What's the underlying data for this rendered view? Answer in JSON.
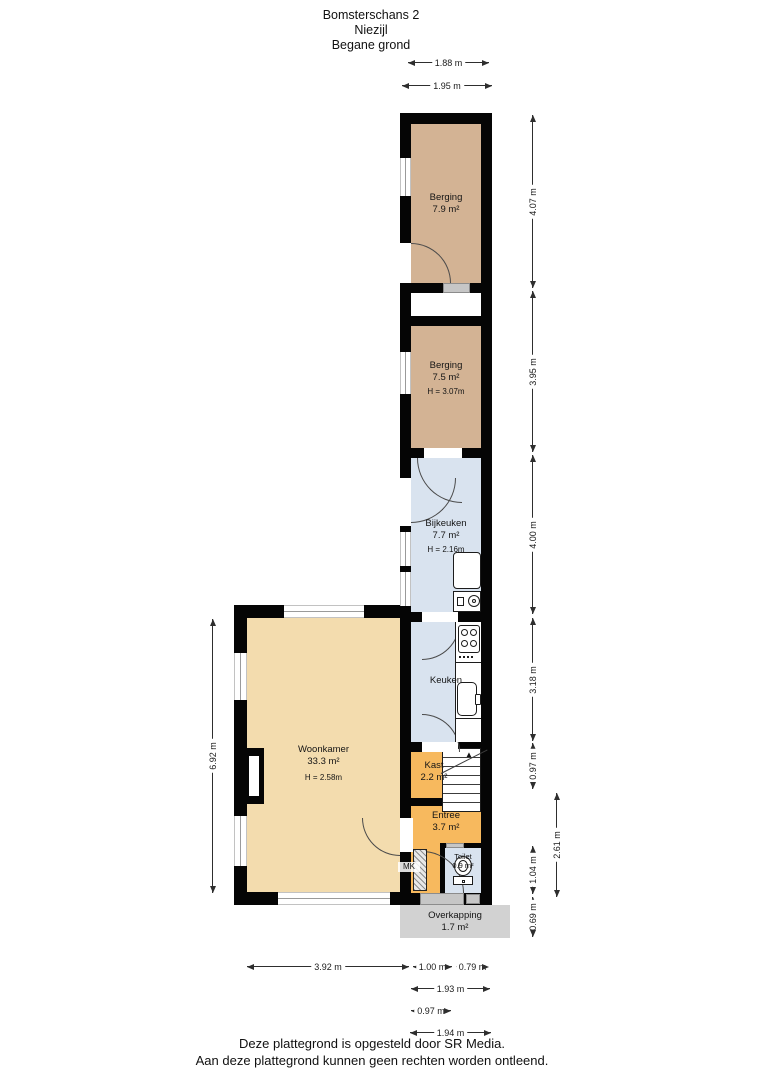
{
  "title": {
    "address": "Bomsterschans 2",
    "city": "Niezijl",
    "floor": "Begane grond"
  },
  "rooms": {
    "berging1": {
      "name": "Berging",
      "area": "7.9 m²"
    },
    "berging2": {
      "name": "Berging",
      "area": "7.5 m²",
      "ceiling": "H = 3.07m"
    },
    "bijkeuken": {
      "name": "Bijkeuken",
      "area": "7.7 m²",
      "ceiling": "H = 2.16m"
    },
    "keuken": {
      "name": "Keuken"
    },
    "woonkamer": {
      "name": "Woonkamer",
      "area": "33.3 m²",
      "ceiling": "H = 2.58m"
    },
    "kast": {
      "name": "Kast",
      "area": "2.2 m²"
    },
    "entree": {
      "name": "Entree",
      "area": "3.7 m²"
    },
    "toilet": {
      "name": "Toilet",
      "area": "0.9 m²"
    },
    "overkapping": {
      "name": "Overkapping",
      "area": "1.7 m²"
    },
    "meterkast": {
      "name": "MK"
    }
  },
  "dimensions": {
    "top": [
      "1.88 m",
      "1.95 m"
    ],
    "right": [
      "4.07 m",
      "3.95 m",
      "4.00 m",
      "3.18 m",
      "0.97 m",
      "1.04 m",
      "0.69 m",
      "2.61 m"
    ],
    "left": [
      "6.92 m"
    ],
    "bottom": [
      "3.92 m",
      "1.00 m",
      "0.79 m",
      "1.93 m",
      "0.97 m",
      "1.94 m"
    ]
  },
  "footer": {
    "line1": "Deze plattegrond is opgesteld door SR Media.",
    "line2": "Aan deze plattegrond kunnen geen rechten worden ontleend."
  },
  "colors": {
    "storage": "#d3b394",
    "living": "#f3dcae",
    "hall": "#f7b95e",
    "wet": "#d9e3ef",
    "canopy": "#d2d2d2",
    "wall": "#050505"
  }
}
